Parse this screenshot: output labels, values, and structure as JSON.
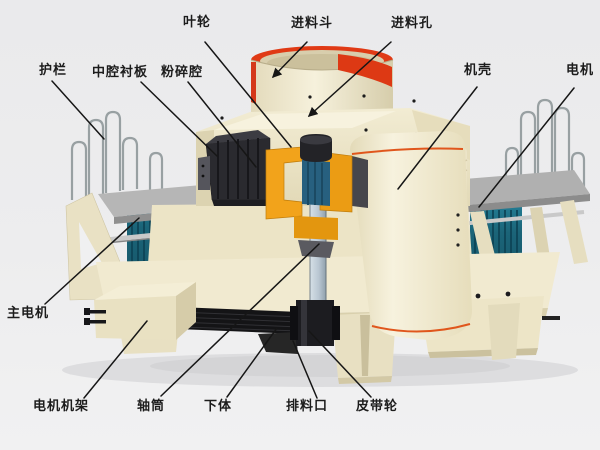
{
  "diagram": {
    "type": "labeled-technical-cutaway-diagram",
    "subject": "vertical shaft impact sand making machine",
    "labels": [
      {
        "id": "impeller",
        "text": "叶轮"
      },
      {
        "id": "feed-hopper",
        "text": "进料斗"
      },
      {
        "id": "feed-hole",
        "text": "进料孔"
      },
      {
        "id": "guardrail",
        "text": "护栏"
      },
      {
        "id": "middle-cavity-liner",
        "text": "中腔衬板"
      },
      {
        "id": "crushing-chamber",
        "text": "粉碎腔"
      },
      {
        "id": "casing",
        "text": "机壳"
      },
      {
        "id": "motor",
        "text": "电机"
      },
      {
        "id": "main-motor",
        "text": "主电机"
      },
      {
        "id": "motor-frame",
        "text": "电机机架"
      },
      {
        "id": "shaft-cylinder",
        "text": "轴筒"
      },
      {
        "id": "lower-body",
        "text": "下体"
      },
      {
        "id": "discharge-port",
        "text": "排料口"
      },
      {
        "id": "belt-pulley",
        "text": "皮带轮"
      }
    ],
    "colors": {
      "background": "#ececee",
      "machine_body_cream": "#f1ead0",
      "hopper_band_red": "#e03a15",
      "impeller_yellow": "#f2a31b",
      "motor_teal": "#1b6478",
      "platform_gray": "#b3b3b3",
      "shaft_silver": "#b9c6d2",
      "liner_dark": "#2a2a2f",
      "leader_line": "#161616"
    }
  }
}
